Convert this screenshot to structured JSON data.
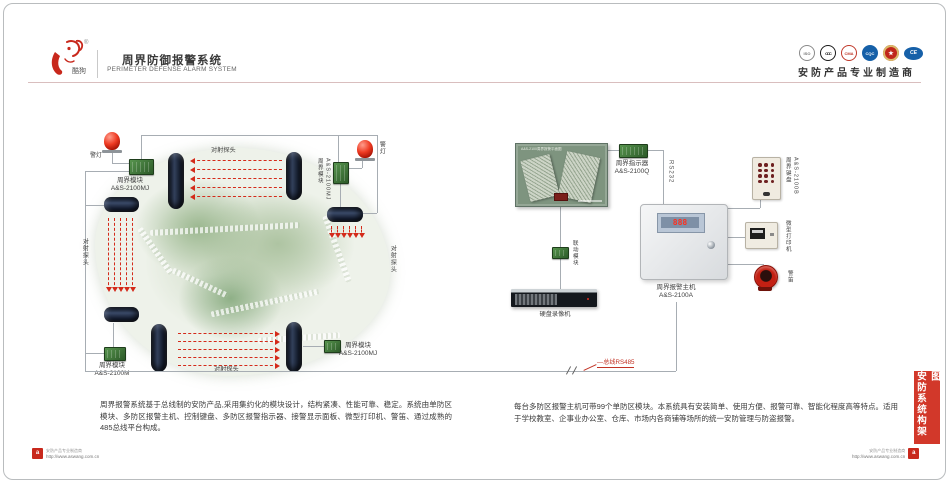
{
  "header": {
    "brand": "酷狗",
    "reg_mark": "®",
    "title_cn": "周界防御报警系统",
    "title_en": "PERIMETER DEFENSE ALARM SYSTEM",
    "slogan": "安防产品专业制造商",
    "certs": [
      {
        "name": "iso",
        "glyph": "ISO"
      },
      {
        "name": "ccc",
        "glyph": "CCC"
      },
      {
        "name": "cma",
        "glyph": "CMA"
      },
      {
        "name": "cqc",
        "glyph": "CQC"
      },
      {
        "name": "medal",
        "glyph": "★"
      },
      {
        "name": "ce",
        "glyph": "CE"
      }
    ]
  },
  "map": {
    "alarm_light_left_label": "警灯",
    "alarm_light_right_label": "警灯",
    "module_top_left": {
      "name": "周界模块",
      "model": "A&S-2100MJ"
    },
    "module_right": {
      "name": "周界模块",
      "model": "A&S-2100MJ"
    },
    "module_bottom_left": {
      "name": "周界模块",
      "model": "A&S-2100M"
    },
    "module_bottom_right": {
      "name": "周界模块",
      "model": "A&S-2100MJ"
    },
    "beam_top_label": "对射探头",
    "beam_left_label": "对射探头",
    "beam_right_label": "对射探头",
    "beam_bottom_label": "对射探头"
  },
  "system": {
    "panel_title": "A&S-2100周界报警平面图",
    "indicator": {
      "name": "周界指示器",
      "model": "A&S-2100Q"
    },
    "rs232_label": "RS232",
    "host": {
      "name": "周界报警主机",
      "model": "A&S-2100A",
      "led": "888"
    },
    "linkage_label": "联动模块",
    "dvr_label": "硬盘录像机",
    "keypad": {
      "name": "周界键盘",
      "model": "A&S-2100B"
    },
    "printer_label": "微型打印机",
    "siren_label": "警笛",
    "bus_label": "—总线RS485"
  },
  "descriptions": {
    "left": "周界报警系统基于总线制的安防产品,采用集约化的模块设计，结构紧凑、性能可靠、稳定。系统由单防区模块、多防区报警主机、控制键盘、多防区报警指示器、接警显示面板、微型打印机、警笛、通过成熟的485总线平台构成。",
    "right": "每台多防区报警主机可带99个单防区模块。本系统具有安装简单、使用方便、报警可靠、智能化程度高等特点。适用于学校教室、企事业办公室、仓库、市场内各商铺等场所的统一安防管理与防盗报警。"
  },
  "side_tab": "安防系统构架图",
  "footer": {
    "slogan": "安防产品专业制造商",
    "url": "http://www.aswang.com.cn",
    "logo_glyph": "a"
  },
  "colors": {
    "accent_red": "#d2382a",
    "beam_red": "#d42a1a",
    "wire_gray": "#a7adb3",
    "divider_pink": "#d9bebe"
  }
}
